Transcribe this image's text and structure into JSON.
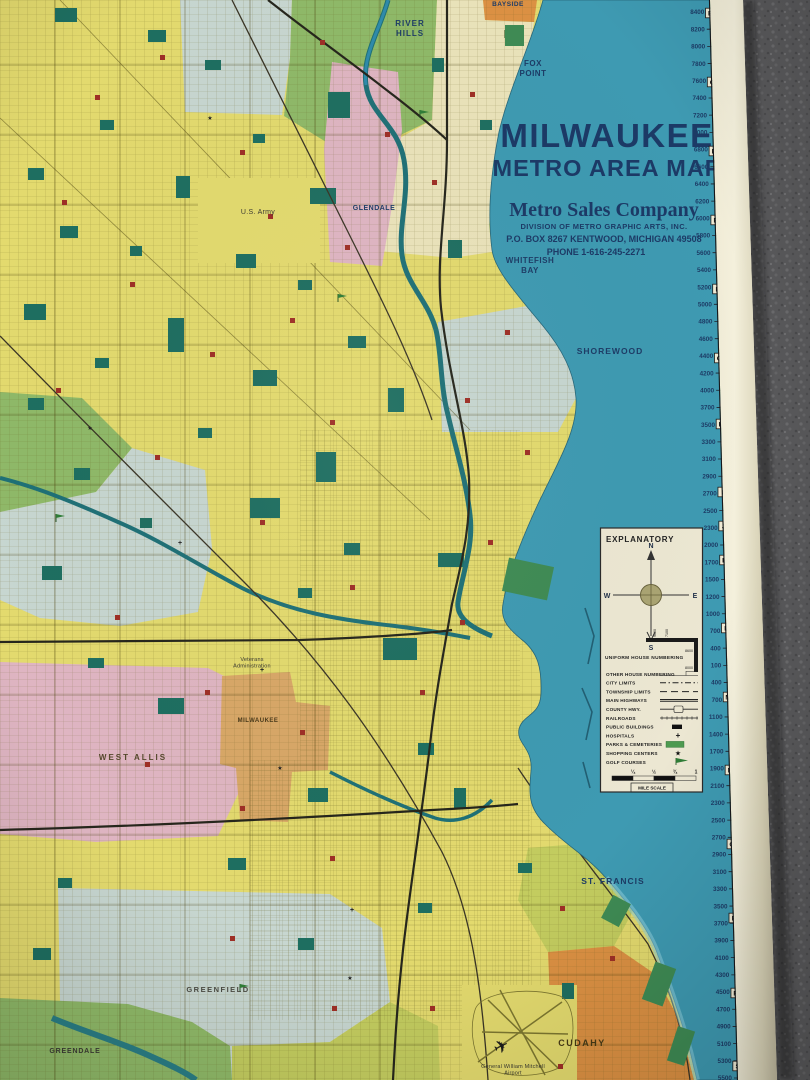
{
  "title_block": {
    "city": "MILWAUKEE",
    "subtitle": "METRO AREA MAP",
    "company": "Metro Sales Company",
    "division": "DIVISION OF METRO GRAPHIC ARTS, INC.",
    "address": "P.O. BOX 8267   KENTWOOD, MICHIGAN 49508",
    "phone": "PHONE 1-616-245-2271"
  },
  "legend": {
    "title": "EXPLANATORY",
    "compass": {
      "n": "N",
      "s": "S",
      "e": "E",
      "w": "W"
    },
    "uniform_house_numbering": {
      "label": "UNIFORM HOUSE NUMBERING",
      "corner_numbers": [
        "9600",
        "7100",
        "8600",
        "8000"
      ]
    },
    "items": [
      {
        "label": "OTHER HOUSE NUMBERING",
        "symbol": "house-numbers"
      },
      {
        "label": "CITY LIMITS",
        "symbol": "city-limits-line"
      },
      {
        "label": "TOWNSHIP LIMITS",
        "symbol": "township-limits-line"
      },
      {
        "label": "MAIN HIGHWAYS",
        "symbol": "main-highway-line"
      },
      {
        "label": "COUNTY HWY.",
        "symbol": "county-highway-line"
      },
      {
        "label": "RAILROADS",
        "symbol": "railroad-line"
      },
      {
        "label": "PUBLIC BUILDINGS",
        "symbol": "black-rectangle"
      },
      {
        "label": "HOSPITALS",
        "symbol": "cross"
      },
      {
        "label": "PARKS & CEMETERIES",
        "symbol": "green-rectangle"
      },
      {
        "label": "SHOPPING CENTERS",
        "symbol": "star"
      },
      {
        "label": "GOLF COURSES",
        "symbol": "golf-flag"
      }
    ],
    "mile_scale": {
      "ticks": [
        "¼",
        "½",
        "¾",
        "1"
      ],
      "label": "MILE SCALE"
    }
  },
  "edge_scale": {
    "numbers": [
      "8400",
      "8200",
      "8000",
      "7800",
      "7600",
      "7400",
      "7200",
      "7000",
      "6800",
      "6600",
      "6400",
      "6200",
      "6000",
      "5800",
      "5600",
      "5400",
      "5200",
      "5000",
      "4800",
      "4600",
      "4400",
      "4200",
      "4000",
      "3700",
      "3500",
      "3300",
      "3100",
      "2900",
      "2700",
      "2500",
      "2300",
      "2000",
      "1700",
      "1500",
      "1200",
      "1000",
      "700",
      "400",
      "100",
      "400",
      "700",
      "1100",
      "1400",
      "1700",
      "1900",
      "2100",
      "2300",
      "2500",
      "2700",
      "2900",
      "3100",
      "3300",
      "3500",
      "3700",
      "3900",
      "4100",
      "4300",
      "4500",
      "4700",
      "4900",
      "5100",
      "5300",
      "5500"
    ],
    "letters": [
      "B",
      "C",
      "D",
      "E",
      "F",
      "G",
      "H",
      "I",
      "J",
      "K",
      "L",
      "M",
      "N",
      "O",
      "P",
      "R",
      "S"
    ]
  },
  "places": [
    {
      "id": "bayside",
      "lines": [
        "BAYSIDE"
      ]
    },
    {
      "id": "river-hills",
      "lines": [
        "RIVER",
        "HILLS"
      ]
    },
    {
      "id": "fox-point",
      "lines": [
        "FOX",
        "POINT"
      ]
    },
    {
      "id": "glendale",
      "lines": [
        "GLENDALE"
      ]
    },
    {
      "id": "us-army",
      "lines": [
        "U.S. Army"
      ]
    },
    {
      "id": "whitefish-bay",
      "lines": [
        "WHITEFISH",
        "BAY"
      ]
    },
    {
      "id": "shorewood",
      "lines": [
        "SHOREWOOD"
      ]
    },
    {
      "id": "veterans-administration",
      "lines": [
        "Veterans",
        "Administration"
      ]
    },
    {
      "id": "milwaukee-village",
      "lines": [
        "MILWAUKEE"
      ]
    },
    {
      "id": "west-allis",
      "lines": [
        "WEST ALLIS"
      ]
    },
    {
      "id": "greenfield",
      "lines": [
        "GREENFIELD"
      ]
    },
    {
      "id": "greendale",
      "lines": [
        "GREENDALE"
      ]
    },
    {
      "id": "st-francis",
      "lines": [
        "ST. FRANCIS"
      ]
    },
    {
      "id": "cudahy",
      "lines": [
        "CUDAHY"
      ]
    },
    {
      "id": "mitchell-airport",
      "lines": [
        "General William Mitchell",
        "Airport"
      ]
    }
  ],
  "airport": {
    "plane_icon": "✈"
  },
  "colors": {
    "lake": "#3e9ab2",
    "lake_shallow": "#8ed0dc",
    "land": "#e3da6e",
    "cream_area": "#eae3ba",
    "pink_area": "#dfb5c2",
    "green_area": "#8fb968",
    "blue_gray_area": "#c7d6d0",
    "orange_area": "#dc9143",
    "tan_area": "#d8a767",
    "chartreuse_area": "#c3cc5f",
    "park": "#1e6e60",
    "shore_park": "#3f8b54",
    "river": "#1f7076",
    "navy_text": "#1d3c66",
    "red_symbol": "#9e2f26",
    "paper": "#e9e4c8",
    "carpet": "#59595b",
    "legend_bg": "#ece7d2"
  }
}
